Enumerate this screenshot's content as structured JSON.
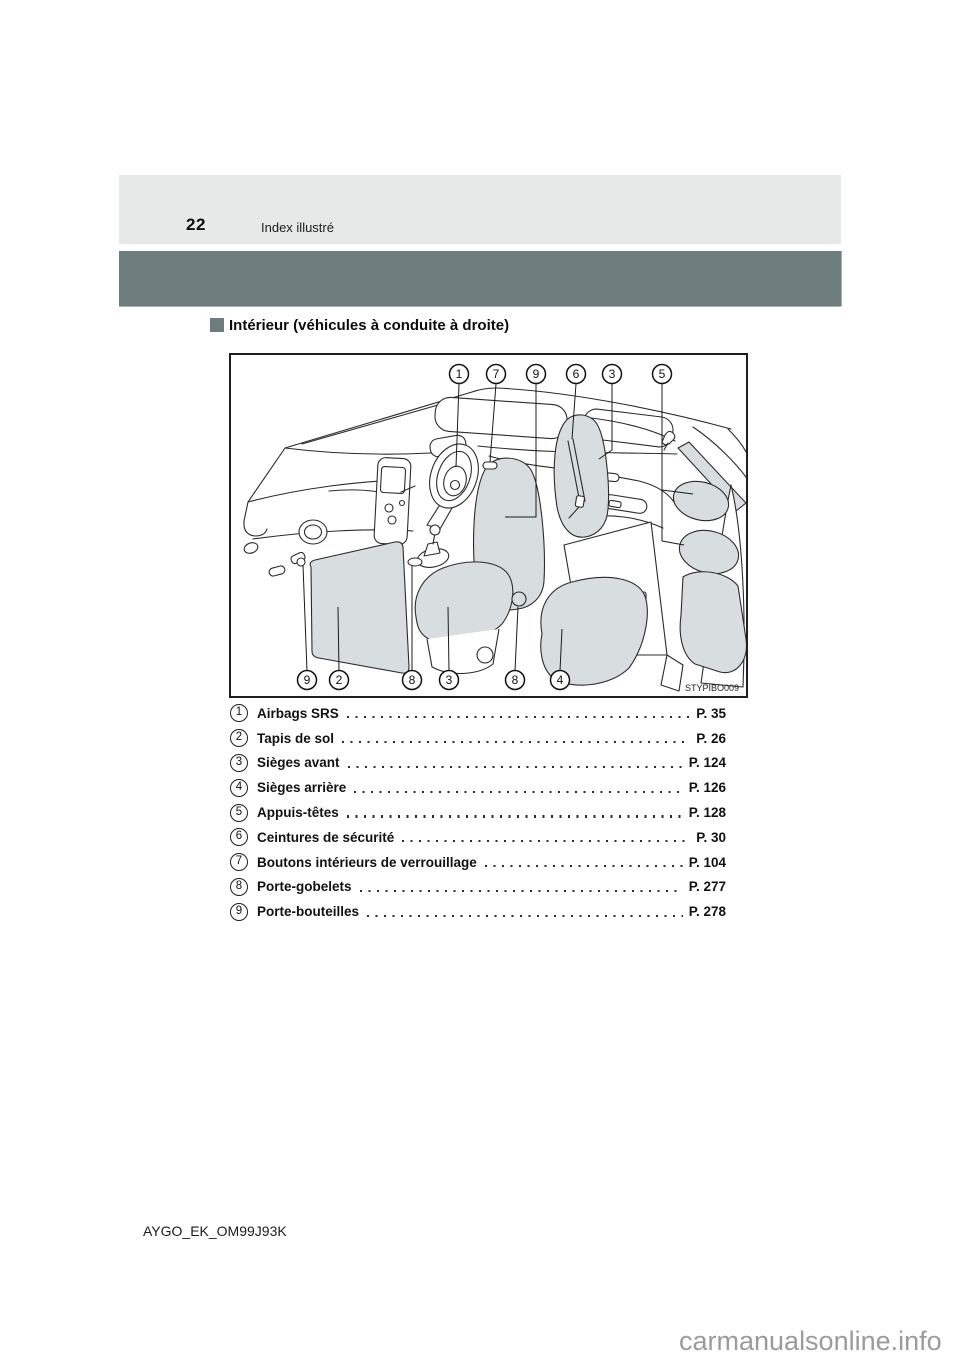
{
  "page": {
    "number": "22",
    "section_header": "Index illustré",
    "footer_code": "AYGO_EK_OM99J93K",
    "watermark": "carmanualsonline.info"
  },
  "content": {
    "section_title": "Intérieur (véhicules à conduite à droite)",
    "figure": {
      "code": "STYPIBO009",
      "description": "interior-line-drawing-right-hand-drive",
      "callouts_top": [
        "1",
        "7",
        "9",
        "6",
        "3",
        "5"
      ],
      "callouts_bottom": [
        "9",
        "2",
        "8",
        "3",
        "8",
        "4"
      ]
    },
    "index_items": [
      {
        "num": "1",
        "label": "Airbags SRS",
        "page": "P. 35"
      },
      {
        "num": "2",
        "label": "Tapis de sol",
        "page": "P. 26"
      },
      {
        "num": "3",
        "label": "Sièges avant",
        "page": "P. 124"
      },
      {
        "num": "4",
        "label": "Sièges arrière",
        "page": "P. 126"
      },
      {
        "num": "5",
        "label": "Appuis-têtes",
        "page": "P. 128"
      },
      {
        "num": "6",
        "label": "Ceintures de sécurité",
        "page": "P. 30"
      },
      {
        "num": "7",
        "label": "Boutons intérieurs de verrouillage",
        "page": "P. 104"
      },
      {
        "num": "8",
        "label": "Porte-gobelets",
        "page": "P. 277"
      },
      {
        "num": "9",
        "label": "Porte-bouteilles",
        "page": "P. 278"
      }
    ]
  },
  "colors": {
    "header_bar_light": "#e7e9e8",
    "header_bar_dark": "#6d7c7c",
    "seat_fill": "#d8dde0",
    "watermark_gray": "#9b9b9b"
  }
}
